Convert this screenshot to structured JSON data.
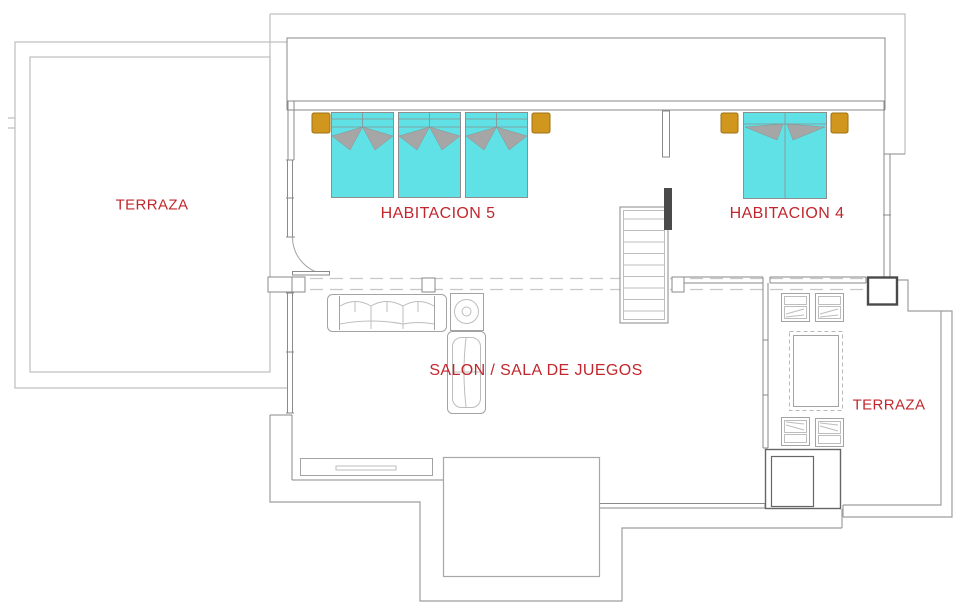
{
  "document": {
    "type": "floor-plan",
    "language": "es"
  },
  "rooms": [
    {
      "id": "terraza-left",
      "label": "TERRAZA"
    },
    {
      "id": "habitacion-5",
      "label": "HABITACION 5"
    },
    {
      "id": "habitacion-4",
      "label": "HABITACION 4"
    },
    {
      "id": "salon",
      "label": "SALON / SALA DE JUEGOS"
    },
    {
      "id": "terraza-right",
      "label": "TERRAZA"
    }
  ],
  "furniture": {
    "habitacion_5": {
      "single_beds": 3,
      "nightstands": 2
    },
    "habitacion_4": {
      "double_beds": 1,
      "nightstands": 2
    },
    "salon": [
      "sofa-3-seat",
      "side-table-with-round-lamp",
      "chaise-longue",
      "sideboard"
    ],
    "terraza_right": [
      "chair",
      "chair",
      "chair",
      "chair",
      "dining-table",
      "planter"
    ],
    "stairs_steps": 10
  },
  "colors": {
    "background": "#ffffff",
    "wall": "#8a8a8a",
    "wall_light": "#bfbfbf",
    "wall_dark": "#4a4a4a",
    "furniture_outline": "#a3a3a3",
    "bed_fill": "#5fe1e6",
    "bed_border": "#8e8e8e",
    "blanket_gray": "#a6a6a6",
    "nightstand_fill": "#d0961d",
    "nightstand_border": "#9c7113",
    "dashed_line": "#c6c6c6",
    "label_red": "#c1272d"
  }
}
